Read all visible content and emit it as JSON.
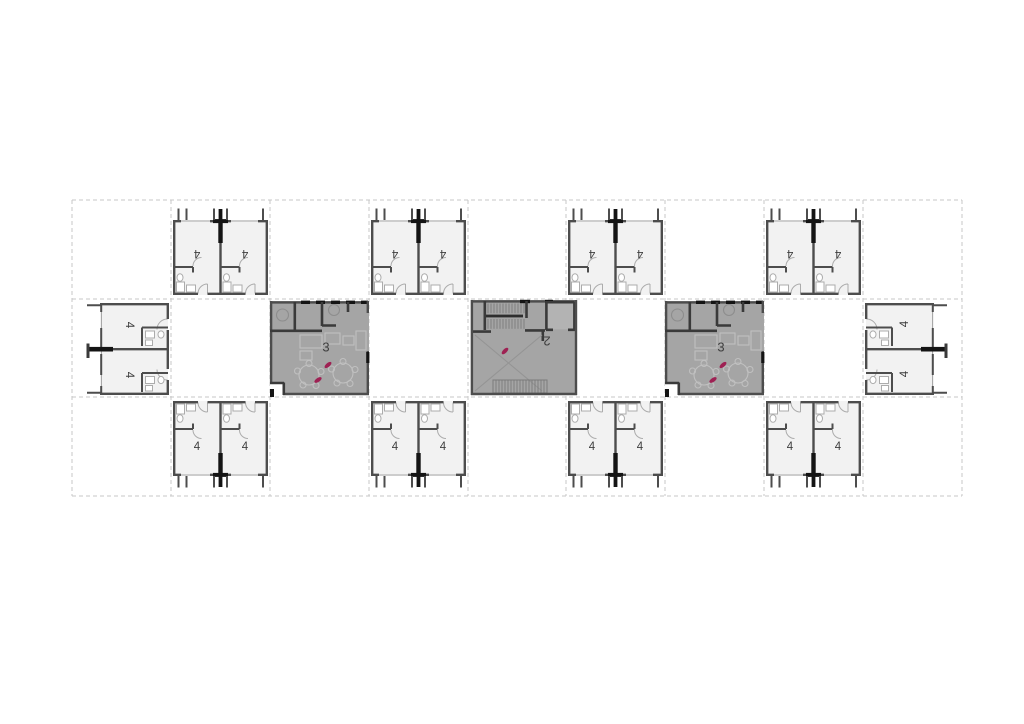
{
  "page": {
    "type": "architectural-floor-plan",
    "sheet_background": "#ffffff"
  },
  "colors": {
    "bg": "#ffffff",
    "wall": "#4d4d4d",
    "wall_room": "#3a3a3a",
    "wall_dark": "#141414",
    "stair_dark": "#2e2e2e",
    "unit_fill": "#f2f2f2",
    "common_fill": "#a5a5a5",
    "elevator_fill": "#b3b3b3",
    "fixture": "#acacac",
    "window_line": "#a8a8a8",
    "furniture": "#c0c0c0",
    "furniture_dark": "#8d8d8d",
    "hatch": "#7b7b7b",
    "void_line": "#949494",
    "grid_dash": "#c7c7c7",
    "accent": "#9e2153",
    "label": "#3e3e3e"
  },
  "labels": {
    "unit": "4",
    "lounge": "3",
    "core": "2"
  },
  "plan": {
    "cols": [
      72,
      171,
      270,
      369,
      468,
      566,
      665,
      764,
      863,
      962
    ],
    "rows": [
      200,
      299,
      397,
      496
    ],
    "placements": [
      {
        "type": "unit-pair",
        "name": "unit-pair-top-1",
        "col": 1,
        "row": 0,
        "flip": "v",
        "labels": [
          {
            "text": "4",
            "x": 26,
            "y": 53,
            "rot": 180
          },
          {
            "text": "4",
            "x": 74,
            "y": 53,
            "rot": 180
          }
        ]
      },
      {
        "type": "unit-pair",
        "name": "unit-pair-top-2",
        "col": 3,
        "row": 0,
        "flip": "v",
        "labels": [
          {
            "text": "4",
            "x": 26,
            "y": 53,
            "rot": 180
          },
          {
            "text": "4",
            "x": 74,
            "y": 53,
            "rot": 180
          }
        ]
      },
      {
        "type": "unit-pair",
        "name": "unit-pair-top-3",
        "col": 5,
        "row": 0,
        "flip": "v",
        "labels": [
          {
            "text": "4",
            "x": 26,
            "y": 53,
            "rot": 180
          },
          {
            "text": "4",
            "x": 74,
            "y": 53,
            "rot": 180
          }
        ]
      },
      {
        "type": "unit-pair",
        "name": "unit-pair-top-4",
        "col": 7,
        "row": 0,
        "flip": "v",
        "labels": [
          {
            "text": "4",
            "x": 26,
            "y": 53,
            "rot": 180
          },
          {
            "text": "4",
            "x": 74,
            "y": 53,
            "rot": 180
          }
        ]
      },
      {
        "type": "unit-pair",
        "name": "unit-pair-bottom-1",
        "col": 1,
        "row": 2,
        "labels": [
          {
            "text": "4",
            "x": 26,
            "y": 50,
            "rot": 0
          },
          {
            "text": "4",
            "x": 74,
            "y": 50,
            "rot": 0
          }
        ]
      },
      {
        "type": "unit-pair",
        "name": "unit-pair-bottom-2",
        "col": 3,
        "row": 2,
        "labels": [
          {
            "text": "4",
            "x": 26,
            "y": 50,
            "rot": 0
          },
          {
            "text": "4",
            "x": 74,
            "y": 50,
            "rot": 0
          }
        ]
      },
      {
        "type": "unit-pair",
        "name": "unit-pair-bottom-3",
        "col": 5,
        "row": 2,
        "labels": [
          {
            "text": "4",
            "x": 26,
            "y": 50,
            "rot": 0
          },
          {
            "text": "4",
            "x": 74,
            "y": 50,
            "rot": 0
          }
        ]
      },
      {
        "type": "unit-pair",
        "name": "unit-pair-bottom-4",
        "col": 7,
        "row": 2,
        "labels": [
          {
            "text": "4",
            "x": 26,
            "y": 50,
            "rot": 0
          },
          {
            "text": "4",
            "x": 74,
            "y": 50,
            "rot": 0
          }
        ]
      },
      {
        "type": "end-unit",
        "name": "end-units-west",
        "col": 0,
        "row": 1,
        "labels": [
          {
            "text": "4",
            "x": 57,
            "y": 26,
            "rot": 90
          },
          {
            "text": "4",
            "x": 57,
            "y": 76,
            "rot": 90
          }
        ]
      },
      {
        "type": "end-unit",
        "name": "end-units-east",
        "col": 8,
        "row": 1,
        "flip": "h",
        "labels": [
          {
            "text": "4",
            "x": 42,
            "y": 25,
            "rot": -90
          },
          {
            "text": "4",
            "x": 42,
            "y": 75,
            "rot": -90
          }
        ]
      },
      {
        "type": "common",
        "name": "shared-lounge-west",
        "col": 2,
        "row": 1,
        "labels": [
          {
            "text": "3",
            "x": 56,
            "y": 48,
            "rot": 0,
            "size": "lg"
          }
        ],
        "marks": [
          {
            "x": 58,
            "y": 66,
            "rot": -40
          },
          {
            "x": 48,
            "y": 81,
            "rot": -35
          }
        ]
      },
      {
        "type": "common",
        "name": "shared-lounge-east",
        "col": 6,
        "row": 1,
        "labels": [
          {
            "text": "3",
            "x": 56,
            "y": 48,
            "rot": 0,
            "size": "lg"
          }
        ],
        "marks": [
          {
            "x": 58,
            "y": 66,
            "rot": -40
          },
          {
            "x": 48,
            "y": 81,
            "rot": -35
          }
        ]
      },
      {
        "type": "core",
        "name": "stair-core",
        "col": 4,
        "row": 1,
        "dx": 3,
        "labels": [
          {
            "text": "2",
            "x": 79,
            "y": 42,
            "rot": 180,
            "size": "lg"
          }
        ],
        "marks": [
          {
            "x": 37,
            "y": 52,
            "rot": -45
          }
        ]
      }
    ]
  }
}
